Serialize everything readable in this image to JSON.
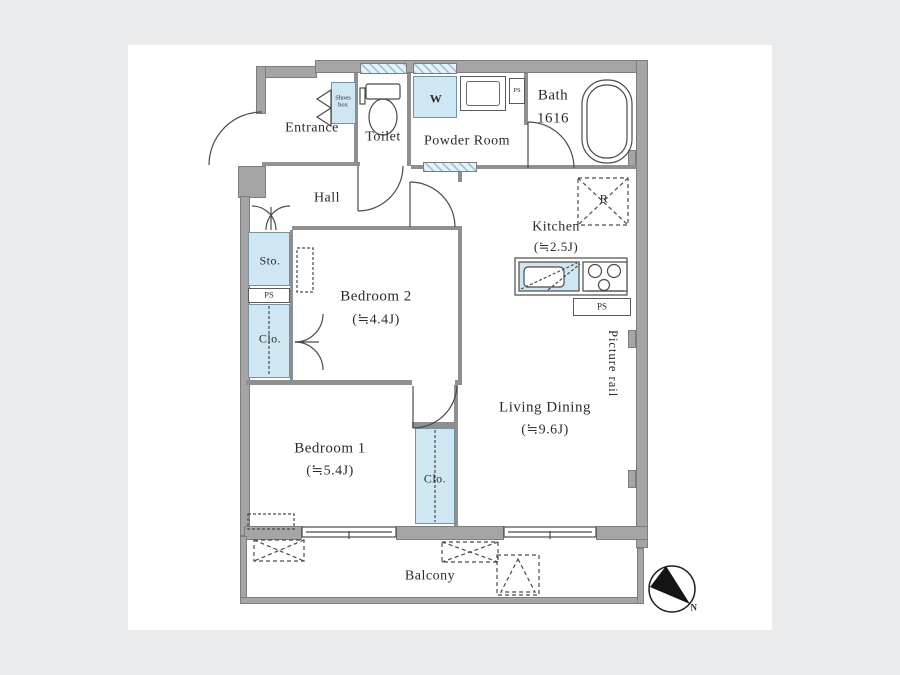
{
  "plan_title": "apartment-floor-plan",
  "colors": {
    "background": "#e9ebed",
    "panel": "#ffffff",
    "wall": "#a5a5a5",
    "fixture_blue": "#cfe6f3",
    "line": "#4a4a4a"
  },
  "rooms": {
    "entrance": {
      "label": "Entrance"
    },
    "hall": {
      "label": "Hall"
    },
    "toilet": {
      "label": "Toilet"
    },
    "powder_room": {
      "label": "Powder Room"
    },
    "bath": {
      "label": "Bath",
      "size": "1616"
    },
    "kitchen": {
      "label": "Kitchen",
      "size": "(≒2.5J)"
    },
    "bedroom2": {
      "label": "Bedroom 2",
      "size": "(≒4.4J)"
    },
    "bedroom1": {
      "label": "Bedroom 1",
      "size": "(≒5.4J)"
    },
    "living_dining": {
      "label": "Living Dining",
      "size": "(≒9.6J)"
    },
    "balcony": {
      "label": "Balcony"
    }
  },
  "fixtures": {
    "shoes_box": "Shoes box",
    "washer": "W",
    "refrigerator": "R",
    "storage": "Sto.",
    "closet_left": "Clo.",
    "closet_bedroom1": "Clo.",
    "pipe_space_top": "PS",
    "pipe_space_left": "PS",
    "pipe_space_kitchen": "PS",
    "picture_rail": "Picture rail",
    "compass_north": "N"
  }
}
